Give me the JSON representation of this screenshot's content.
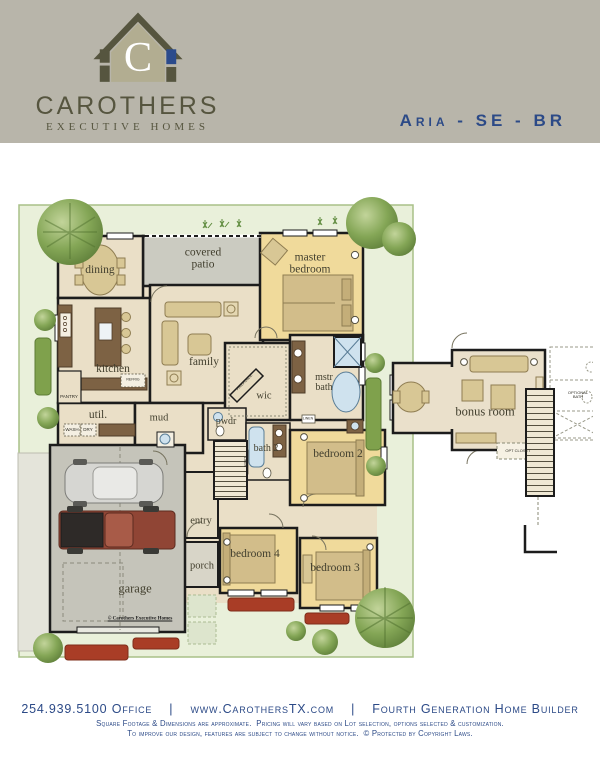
{
  "header": {
    "brand": "CAROTHERS",
    "brand_sub": "EXECUTIVE HOMES",
    "logo_letter": "C",
    "plan_title": "Aria - SE - BR"
  },
  "plan": {
    "labels": {
      "dining": "dining",
      "covered_patio": "covered patio",
      "master_bedroom": "master bedroom",
      "family": "family",
      "kitchen": "kitchen",
      "util": "util.",
      "mud": "mud",
      "pwdr": "pwdr",
      "wic": "wic",
      "mstr_bath": "mstr bath",
      "bath2": "bath 2",
      "bedroom2": "bedroom 2",
      "entry": "entry",
      "porch": "porch",
      "bedroom4": "bedroom 4",
      "bedroom3": "bedroom 3",
      "garage": "garage",
      "bonus_room": "bonus room"
    },
    "small_labels": {
      "pantry": "PANTRY",
      "wash": "WASH",
      "dry": "DRY",
      "linen": "LINEN",
      "fireplace": "FIREPLACE",
      "refrig": "REFRIG",
      "opt_closet": "OPT CLOSET",
      "optional_bath": "OPTIONAL BATH",
      "copyright": "© Carothers Executive Homes"
    }
  },
  "footer": {
    "line1": "254.939.5100 Office    |    www.CarothersTX.com    |    Fourth Generation Home Builder",
    "line2": "Square Footage & Dimensions are approximate.  Pricing will vary based on Lot selection, options selected & customization.",
    "line3": "To improve our design, features are subject to change without notice.  © Protected by Copyright Laws."
  },
  "colors": {
    "header_bg": "#b8b5aa",
    "accent_blue": "#2c4a87",
    "olive": "#56553f",
    "khaki": "#b2ad91",
    "room_beige": "#eadfc7",
    "bedroom_yellow": "#f0da9b",
    "patio_gray": "#cbcbc1",
    "lot_green": "#e9f0da"
  }
}
